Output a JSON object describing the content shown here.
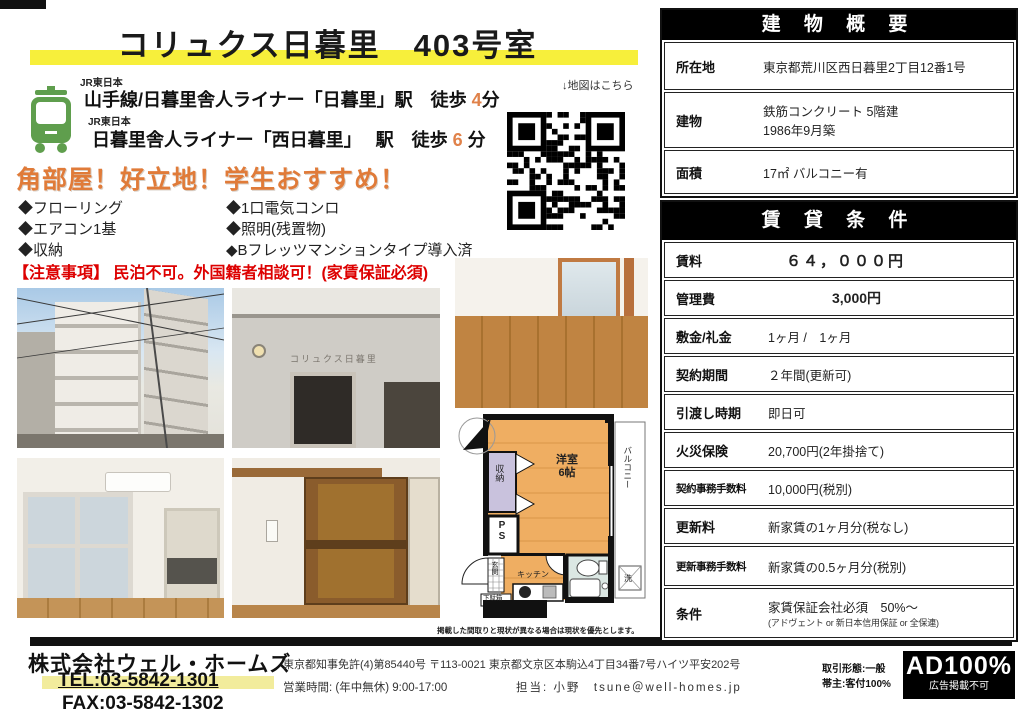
{
  "page": {
    "title": "コリュクス日暮里　403号室"
  },
  "access": {
    "map_note": "↓地図はこちら",
    "lines": [
      {
        "company": "JR東日本",
        "station": "山手線/日暮里舎人ライナー「日暮里」駅",
        "walk": "　徒歩 ",
        "minutes": "4",
        "unit": "分"
      },
      {
        "company": "JR東日本",
        "station": "日暮里舎人ライナー「西日暮里」　 駅",
        "walk": "　徒歩 ",
        "minutes": "6",
        "unit": " 分"
      }
    ]
  },
  "catchphrase": "角部屋！好立地！学生おすすめ！",
  "features": {
    "col1": [
      "◆フローリング",
      "◆エアコン1基",
      "◆収納"
    ],
    "col2": [
      "◆1口電気コンロ",
      "◆照明(残置物)",
      "◆Bフレッツマンションタイプ導入済"
    ]
  },
  "notice": "【注意事項】 民泊不可。外国籍者相談可！(家賃保証必須)",
  "building_table": {
    "header": "建 物 概 要",
    "rows": [
      {
        "label": "所在地",
        "value": "東京都荒川区西日暮里2丁目12番1号"
      },
      {
        "label": "建物",
        "value": "鉄筋コンクリート 5階建\n1986年9月築"
      },
      {
        "label": "面積",
        "value": "17㎡ バルコニー有"
      }
    ]
  },
  "rent_table": {
    "header": "賃 貸 条 件",
    "rows": [
      {
        "label": "賃料",
        "value": "６４，０００円"
      },
      {
        "label": "管理費",
        "value": "3,000円"
      },
      {
        "label": "敷金/礼金",
        "value": "1ヶ月 /　1ヶ月"
      },
      {
        "label": "契約期間",
        "value": "２年間(更新可)"
      },
      {
        "label": "引渡し時期",
        "value": "即日可"
      },
      {
        "label": "火災保険",
        "value": "20,700円(2年掛捨て)"
      },
      {
        "label": "契約事務手数料",
        "value": "10,000円(税別)"
      },
      {
        "label": "更新料",
        "value": "新家賃の1ヶ月分(税なし)"
      },
      {
        "label": "更新事務手数料",
        "value": "新家賃の0.5ヶ月分(税別)"
      },
      {
        "label": "条件",
        "value": "家賃保証会社必須　50%～",
        "sub": "(アドヴェント or 新日本信用保証 or 全保連)"
      }
    ]
  },
  "photos": {
    "building_sign": "コリュクス日暮里"
  },
  "floorplan": {
    "labels": {
      "room": "洋室\n6帖",
      "closet": "収納",
      "ps": "PS",
      "balcony": "バルコニー",
      "entrance": "玄関",
      "kitchen": "キッチン",
      "shoe_box": "下駄箱",
      "washer": "洗"
    },
    "disclaimer": "掲載した間取りと現状が異なる場合は現状を優先とします。"
  },
  "footer": {
    "company": "株式会社ウェル・ホームズ",
    "tel": "TEL:03-5842-1301",
    "fax": "FAX:03-5842-1302",
    "license_line": "東京都知事免許(4)第85440号 〒113-0021 東京都文京区本駒込4丁目34番7号ハイツ平安202号",
    "hours_line": "営業時間: (年中無休) 9:00-17:00",
    "contact_line": "担当: 小野　tsune＠well-homes.jp",
    "deal_type": "取引形態:一般",
    "lead": "帯主:客付100%",
    "ad": "AD100%",
    "ad_sub": "広告掲載不可"
  },
  "colors": {
    "title_highlight": "#f7ef3b",
    "catch_orange": "#e07b39",
    "notice_red": "#dd0000",
    "train_green": "#5f9e4d",
    "plan_floor": "#efae62",
    "plan_closet": "#c9c2dd",
    "plan_bath": "#dbe7e3"
  }
}
